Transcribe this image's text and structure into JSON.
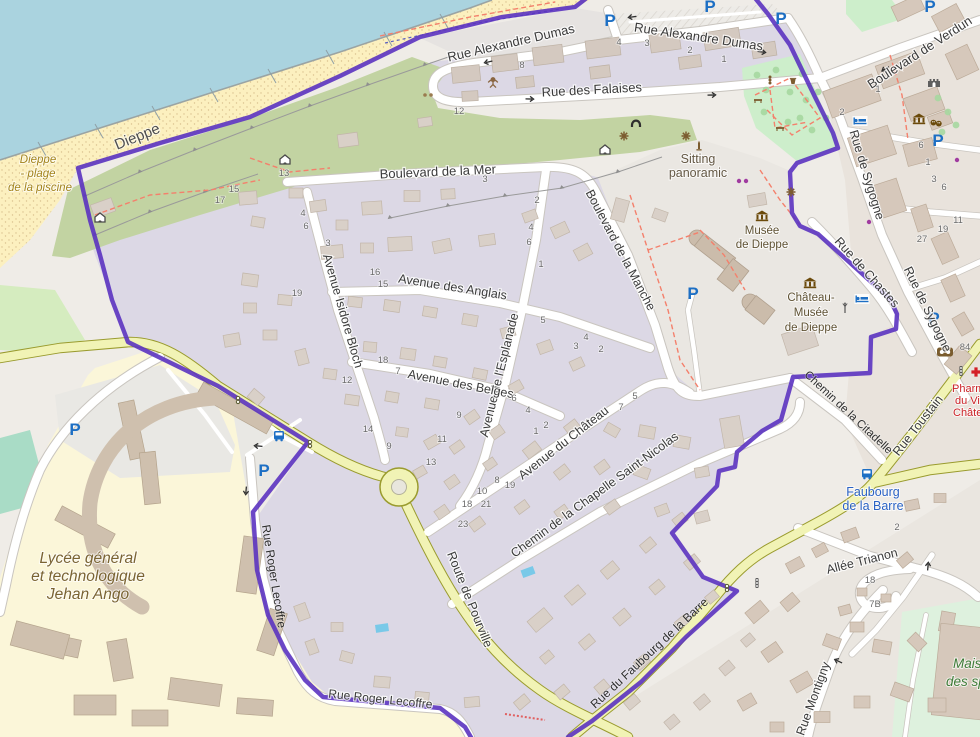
{
  "colors": {
    "boundary_purple": "#5b33c0",
    "parking_blue": "#1d6fc4",
    "water_blue": "#aad3df",
    "road_yellow": "#f1f3b5"
  },
  "icons": {
    "parking_letter": "P"
  },
  "streets": [
    {
      "name": "Rue Alexandre Dumas"
    },
    {
      "name": "Rue Alexandre Dumas"
    },
    {
      "name": "Rue des Falaises"
    },
    {
      "name": "Boulevard de la Mer"
    },
    {
      "name": "Boulevard de la Manche"
    },
    {
      "name": "Avenue des Anglais"
    },
    {
      "name": "Avenue Isidore Bloch"
    },
    {
      "name": "Avenue de l'Esplanade"
    },
    {
      "name": "Avenue des Belges"
    },
    {
      "name": "Avenue du Château"
    },
    {
      "name": "Chemin de la Chapelle Saint-Nicolas"
    },
    {
      "name": "Route de Pourville"
    },
    {
      "name": "Rue Roger Lecoffre"
    },
    {
      "name": "Rue Roger Lecoffre"
    },
    {
      "name": "Rue du Faubourg de la Barre"
    },
    {
      "name": "Rue Montigny"
    },
    {
      "name": "Allée Trianon"
    },
    {
      "name": "Rue Toustain"
    },
    {
      "name": "Chemin de la Citadelle"
    },
    {
      "name": "Rue de Chastes"
    },
    {
      "name": "Rue de Sygogne"
    },
    {
      "name": "Rue de Sygogne"
    },
    {
      "name": "Boulevard de Verdun"
    },
    {
      "name": "Dieppe"
    }
  ],
  "places": {
    "plage1": "Dieppe",
    "plage2": "- plage",
    "plage3": "de la piscine",
    "lycee1": "Lycée général",
    "lycee2": "et technologique",
    "lycee3": "Jehan Ango",
    "sitting1": "Sitting",
    "sitting2": "panoramic",
    "musee1": "Musée",
    "musee2": "de Dieppe",
    "chateau1": "Château-",
    "chateau2": "Musée",
    "chateau3": "de Dieppe",
    "stop1": "Faubourg",
    "stop2": "de la Barre",
    "pharmacy1": "Pharmacie",
    "pharmacy2": "du Vieux",
    "pharmacy3": "Château",
    "sports1": "Maison",
    "sports2": "des sports"
  },
  "house_numbers": [
    [
      284,
      176,
      "13"
    ],
    [
      234,
      192,
      "15"
    ],
    [
      220,
      203,
      "17"
    ],
    [
      303,
      216,
      "4"
    ],
    [
      306,
      229,
      "6"
    ],
    [
      328,
      246,
      "3"
    ],
    [
      522,
      68,
      "8"
    ],
    [
      619,
      45,
      "4"
    ],
    [
      647,
      46,
      "3"
    ],
    [
      690,
      53,
      "2"
    ],
    [
      724,
      62,
      "1"
    ],
    [
      459,
      114,
      "12"
    ],
    [
      485,
      182,
      "3"
    ],
    [
      537,
      203,
      "2"
    ],
    [
      531,
      230,
      "4"
    ],
    [
      529,
      245,
      "6"
    ],
    [
      541,
      267,
      "1"
    ],
    [
      375,
      275,
      "16"
    ],
    [
      383,
      287,
      "15"
    ],
    [
      297,
      296,
      "19"
    ],
    [
      543,
      323,
      "5"
    ],
    [
      586,
      340,
      "4"
    ],
    [
      576,
      349,
      "3"
    ],
    [
      601,
      352,
      "2"
    ],
    [
      383,
      363,
      "18"
    ],
    [
      398,
      374,
      "7"
    ],
    [
      347,
      383,
      "12"
    ],
    [
      514,
      401,
      "6"
    ],
    [
      459,
      418,
      "9"
    ],
    [
      442,
      442,
      "11"
    ],
    [
      431,
      465,
      "13"
    ],
    [
      389,
      449,
      "9"
    ],
    [
      368,
      432,
      "14"
    ],
    [
      528,
      413,
      "4"
    ],
    [
      546,
      428,
      "2"
    ],
    [
      536,
      434,
      "1"
    ],
    [
      621,
      410,
      "7"
    ],
    [
      635,
      399,
      "5"
    ],
    [
      497,
      483,
      "8"
    ],
    [
      510,
      488,
      "19"
    ],
    [
      482,
      494,
      "10"
    ],
    [
      467,
      507,
      "18"
    ],
    [
      486,
      507,
      "21"
    ],
    [
      463,
      527,
      "23"
    ],
    [
      878,
      92,
      "1"
    ],
    [
      842,
      115,
      "2"
    ],
    [
      921,
      148,
      "6"
    ],
    [
      928,
      165,
      "1"
    ],
    [
      934,
      182,
      "3"
    ],
    [
      944,
      190,
      "6"
    ],
    [
      958,
      223,
      "11"
    ],
    [
      943,
      232,
      "19"
    ],
    [
      922,
      242,
      "27"
    ],
    [
      965,
      350,
      "84"
    ],
    [
      870,
      583,
      "18"
    ],
    [
      875,
      607,
      "7B"
    ],
    [
      897,
      530,
      "2"
    ]
  ]
}
